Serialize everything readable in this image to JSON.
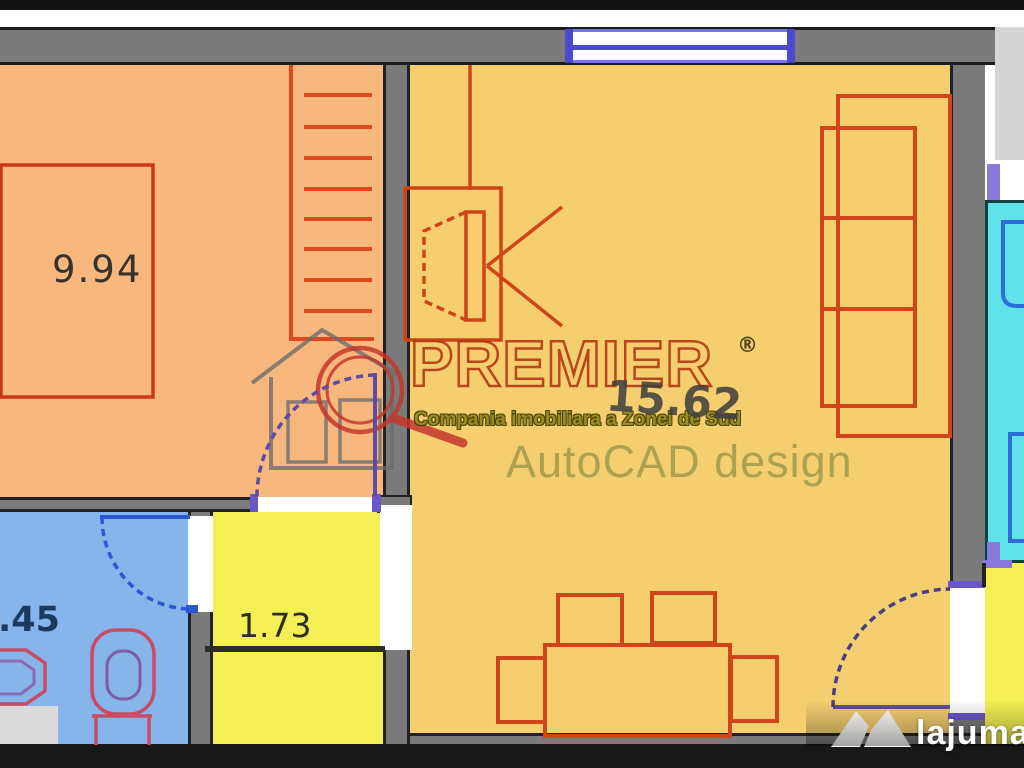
{
  "plan": {
    "type": "apartment floor plan",
    "rooms": {
      "bedroom": {
        "area": "9.94",
        "fill": "#F8B77C"
      },
      "living": {
        "area": "15.62",
        "fill": "#F5CE70"
      },
      "hallway": {
        "area": "1.73",
        "fill": "#F3EF55"
      },
      "bathroom": {
        "area": ".45",
        "fill": "#85B5EB"
      },
      "kitchen": {
        "fill": "#5FE2EA"
      },
      "entry": {
        "fill": "#F3EF55"
      }
    },
    "wall_color": "#7B7B7B",
    "furniture_line_color": "#CF4419",
    "door_arc_color": "#5E4BA8",
    "window_frame_color": "#4A4ACE"
  },
  "watermarks": {
    "premier": {
      "brand": "PREMIER",
      "registered": "®",
      "tagline": "Compania imobiliara a Zonei de Sud"
    },
    "autocad": "AutoCAD design",
    "lajumate": {
      "name": "lajumate",
      "tld": ".ro"
    }
  }
}
